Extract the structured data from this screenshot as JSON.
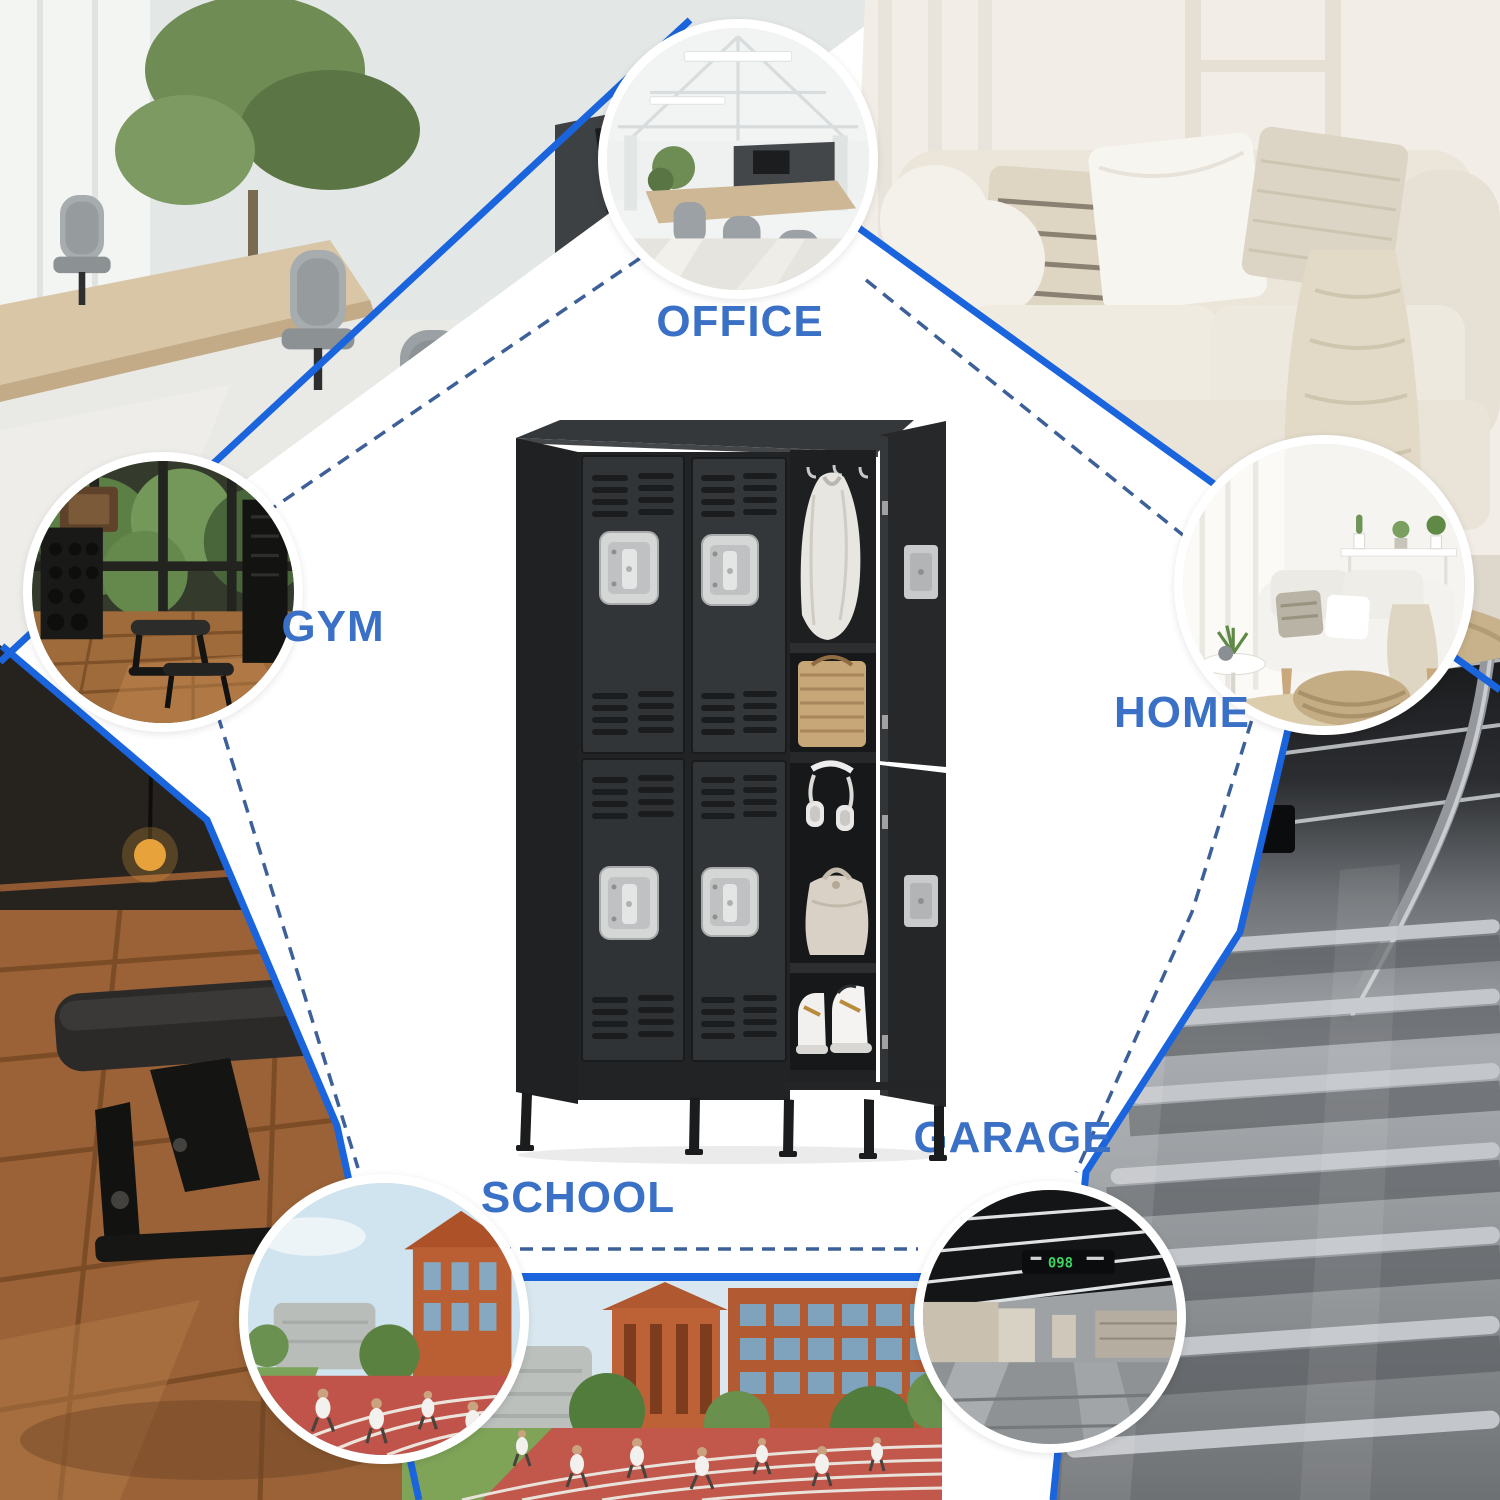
{
  "labels": {
    "office": "OFFICE",
    "gym": "GYM",
    "home": "HOME",
    "school": "SCHOOL",
    "garage": "GARAGE"
  },
  "garage_sign": {
    "number": "098",
    "arrow": "→",
    "text_cn": "更多车位",
    "subtext": "More Parking"
  },
  "palette": {
    "background": "#ffffff",
    "solid_line_blue": "#1a64dd",
    "dashed_line_blue": "#3d6099",
    "label_blue": "#3a70c5",
    "locker_body": "#2d2f31",
    "handle_silver": "#d5d6d6",
    "led_green": "#3ed45f",
    "circle_ring": "#ffffff"
  }
}
